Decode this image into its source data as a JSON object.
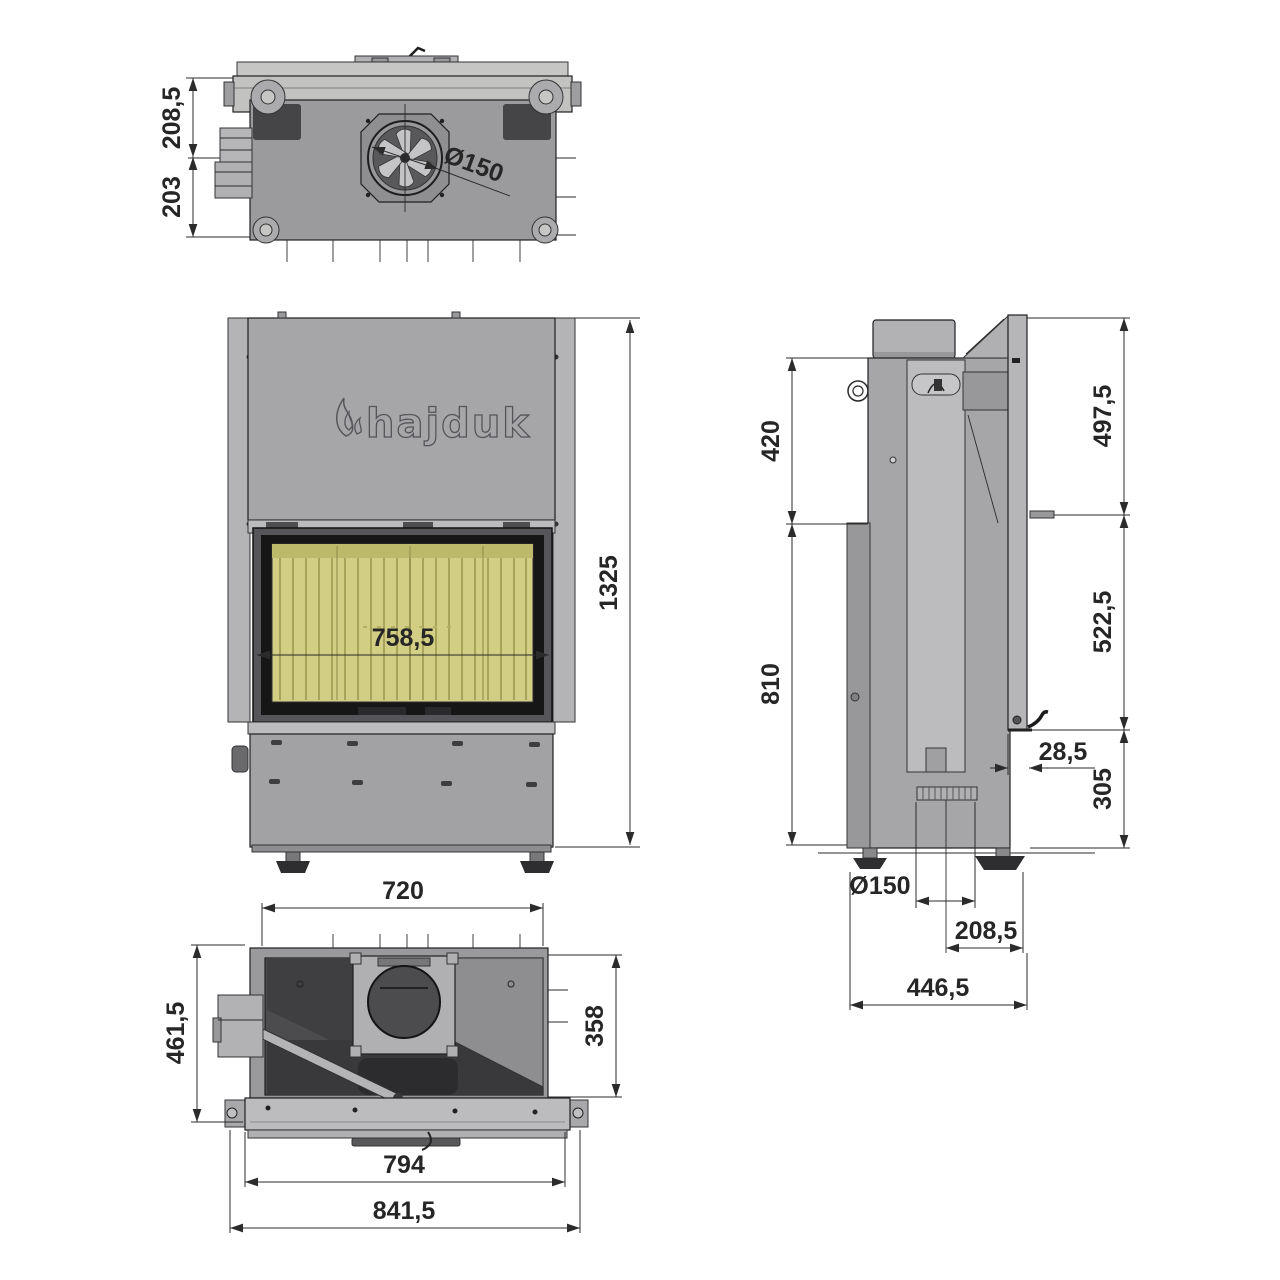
{
  "drawing": {
    "brand": "hajduk",
    "product": "fireplace insert technical drawing",
    "colors": {
      "firebrick": "#d2ce83",
      "firebrick_rib": "#a7a35a",
      "steel_light": "#bcbcbe",
      "steel_mid": "#a4a4a6",
      "steel_dark": "#4c4c4e",
      "line": "#2b2b2b"
    },
    "views": {
      "top": {
        "label": "top view",
        "dims": {
          "front_to_flue_axis": "208,5",
          "flue_axis_to_rear": "203",
          "flue_diameter": "Ø150"
        }
      },
      "front": {
        "label": "front view",
        "dims": {
          "glass_width": "758,5",
          "total_height": "1325"
        }
      },
      "side": {
        "label": "side view",
        "dims": {
          "hood_section_height": "420",
          "body_section_height": "810",
          "upper_right_height": "497,5",
          "middle_right_height": "522,5",
          "frame_depth": "28,5",
          "lower_right_height": "305",
          "inlet_diameter": "Ø150",
          "inlet_axis_to_front": "208,5",
          "total_depth": "446,5"
        }
      },
      "bottom": {
        "label": "bottom view",
        "dims": {
          "inner_width": "720",
          "total_depth": "461,5",
          "body_depth": "358",
          "frame_width": "794",
          "total_width": "841,5"
        }
      }
    }
  }
}
